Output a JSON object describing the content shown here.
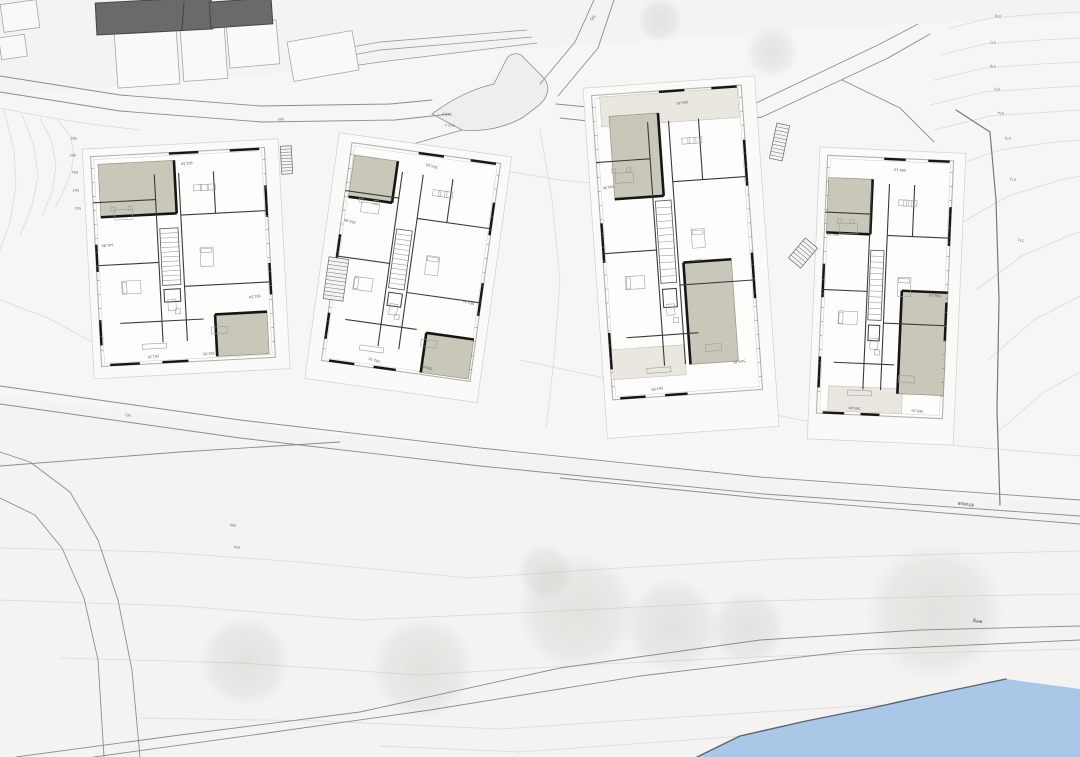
{
  "canvas": {
    "w": 1080,
    "h": 757
  },
  "colors": {
    "background": "#f4f3f1",
    "parcel": "#f7f6f4",
    "building_white": "#fdfdfc",
    "building_outline": "#b3b1ac",
    "terrace_dark": "#c9c7b9",
    "terrace_light": "#e9e7df",
    "existing_dark": "#6a6a6a",
    "wall_black": "#161616",
    "road_line": "#8f8d8b",
    "contour": "#dcdad6",
    "tree": "#b9b8b3",
    "water_fill": "#a9c7e6",
    "water_edge": "#5a6470",
    "label_text": "#444444"
  },
  "site": {
    "parcel": [
      0,
      96,
      300,
      70,
      430,
      56,
      560,
      46,
      820,
      28,
      1080,
      16,
      1080,
      505,
      760,
      478,
      400,
      442,
      0,
      396
    ],
    "contours": [
      [
        950,
        28,
        990,
        18,
        1040,
        14,
        1080,
        12
      ],
      [
        940,
        55,
        985,
        44,
        1040,
        40,
        1080,
        38
      ],
      [
        934,
        80,
        984,
        68,
        1040,
        64,
        1080,
        62
      ],
      [
        930,
        105,
        984,
        92,
        1045,
        88,
        1080,
        86
      ],
      [
        934,
        130,
        990,
        116,
        1050,
        112,
        1080,
        110
      ],
      [
        948,
        168,
        1000,
        150,
        1055,
        142,
        1080,
        140
      ],
      [
        958,
        225,
        1008,
        196,
        1060,
        180,
        1080,
        176
      ],
      [
        976,
        290,
        1022,
        256,
        1068,
        236,
        1080,
        232
      ],
      [
        988,
        360,
        1034,
        320,
        1080,
        296
      ],
      [
        998,
        432,
        1044,
        392,
        1080,
        372
      ],
      [
        58,
        120,
        70,
        136,
        74,
        154,
        71,
        172,
        64,
        190,
        56,
        206
      ],
      [
        40,
        118,
        52,
        142,
        56,
        166,
        52,
        192,
        42,
        216
      ],
      [
        22,
        114,
        34,
        146,
        38,
        176,
        32,
        206,
        20,
        236
      ],
      [
        4,
        110,
        14,
        150,
        16,
        186,
        10,
        222,
        0,
        250
      ],
      [
        0,
        300,
        48,
        318,
        92,
        342,
        130,
        358
      ],
      [
        0,
        108,
        40,
        116,
        90,
        124,
        140,
        130
      ],
      [
        430,
        150,
        500,
        170,
        560,
        180,
        620,
        186
      ],
      [
        540,
        130,
        552,
        200,
        560,
        280,
        554,
        360,
        546,
        428
      ],
      [
        520,
        360,
        660,
        390,
        800,
        420,
        960,
        446,
        1080,
        456
      ],
      [
        0,
        548,
        160,
        552,
        300,
        562,
        470,
        578,
        620,
        568,
        780,
        559,
        950,
        554,
        1080,
        551
      ],
      [
        0,
        600,
        180,
        606,
        360,
        620,
        560,
        611,
        760,
        601,
        960,
        596,
        1080,
        594
      ],
      [
        60,
        658,
        240,
        663,
        420,
        675,
        600,
        664,
        780,
        656,
        960,
        652,
        1080,
        649
      ],
      [
        140,
        718,
        320,
        721,
        500,
        729,
        680,
        717,
        860,
        706,
        1000,
        700
      ],
      [
        380,
        746,
        520,
        752,
        660,
        742,
        800,
        732
      ]
    ],
    "contour_labels": [
      {
        "text": "578",
        "x": 998,
        "y": 15,
        "rot": 187
      },
      {
        "text": "577",
        "x": 993,
        "y": 41,
        "rot": 187
      },
      {
        "text": "576",
        "x": 993,
        "y": 65,
        "rot": 187
      },
      {
        "text": "575",
        "x": 997,
        "y": 88,
        "rot": 187
      },
      {
        "text": "574",
        "x": 1001,
        "y": 112,
        "rot": 187
      },
      {
        "text": "573",
        "x": 1008,
        "y": 137,
        "rot": 187
      },
      {
        "text": "572",
        "x": 1013,
        "y": 178,
        "rot": 190
      },
      {
        "text": "571",
        "x": 1021,
        "y": 239,
        "rot": 195
      },
      {
        "text": "566",
        "x": 74,
        "y": 137,
        "rot": 183
      },
      {
        "text": "565",
        "x": 73,
        "y": 154,
        "rot": 183
      },
      {
        "text": "564",
        "x": 75,
        "y": 171,
        "rot": 183
      },
      {
        "text": "563",
        "x": 76,
        "y": 189,
        "rot": 183
      },
      {
        "text": "562",
        "x": 78,
        "y": 207,
        "rot": 183
      }
    ],
    "path_labels": [
      {
        "text": "565",
        "x": 592,
        "y": 17,
        "rot": 132
      },
      {
        "text": "564",
        "x": 281,
        "y": 118,
        "rot": 175
      },
      {
        "text": "561",
        "x": 128,
        "y": 414,
        "rot": 188
      },
      {
        "text": "565.2",
        "x": 447,
        "y": 113,
        "rot": 185
      },
      {
        "text": "565.7",
        "x": 450,
        "y": 124,
        "rot": 185
      },
      {
        "text": "560",
        "x": 233,
        "y": 524,
        "rot": 185
      },
      {
        "text": "559",
        "x": 237,
        "y": 546,
        "rot": 185
      }
    ],
    "street_labels": [
      {
        "text": "strasse",
        "x": 966,
        "y": 503,
        "rot": 187
      },
      {
        "text": "weg",
        "x": 978,
        "y": 620,
        "rot": 188
      }
    ],
    "trees": [
      [
        423,
        668,
        52
      ],
      [
        577,
        612,
        60
      ],
      [
        672,
        626,
        48
      ],
      [
        935,
        612,
        70
      ],
      [
        748,
        628,
        38
      ],
      [
        545,
        572,
        28
      ],
      [
        245,
        662,
        46
      ],
      [
        508,
        92,
        22
      ],
      [
        772,
        52,
        26
      ],
      [
        660,
        20,
        22
      ]
    ],
    "roads": [
      {
        "name": "road-upper-edge-a",
        "pts": [
          0,
          76,
          120,
          95,
          260,
          106,
          390,
          104,
          432,
          100
        ]
      },
      {
        "name": "road-upper-edge-b",
        "pts": [
          0,
          92,
          120,
          111,
          262,
          122,
          395,
          120,
          450,
          114
        ]
      },
      {
        "name": "path-ne-a",
        "pts": [
          540,
          84,
          575,
          42,
          594,
          0
        ]
      },
      {
        "name": "path-ne-b",
        "pts": [
          558,
          96,
          598,
          48,
          614,
          0
        ]
      },
      {
        "name": "road-right-a",
        "pts": [
          556,
          104,
          660,
          114,
          756,
          103,
          815,
          75,
          880,
          44,
          918,
          24
        ]
      },
      {
        "name": "road-right-b",
        "pts": [
          560,
          118,
          662,
          129,
          762,
          117,
          824,
          88,
          888,
          58,
          930,
          34
        ]
      },
      {
        "name": "drive-b4",
        "pts": [
          842,
          80,
          900,
          108,
          934,
          142
        ]
      },
      {
        "name": "drive-b2",
        "pts": [
          462,
          130,
          420,
          142,
          390,
          150
        ]
      },
      {
        "name": "road-mid-edge-a",
        "pts": [
          0,
          386,
          240,
          420,
          480,
          448,
          760,
          477,
          1080,
          500
        ]
      },
      {
        "name": "road-mid-edge-b",
        "pts": [
          0,
          404,
          240,
          438,
          480,
          466,
          764,
          494,
          1080,
          516
        ]
      },
      {
        "name": "road-mid-walk",
        "pts": [
          560,
          478,
          760,
          498,
          1080,
          524
        ]
      },
      {
        "name": "road-junction-west",
        "pts": [
          0,
          466,
          180,
          452,
          340,
          442
        ]
      },
      {
        "name": "road-left-branch-a",
        "pts": [
          0,
          452,
          30,
          462,
          70,
          492,
          98,
          540,
          118,
          600,
          132,
          670,
          140,
          757
        ]
      },
      {
        "name": "road-left-branch-b",
        "pts": [
          0,
          498,
          35,
          515,
          62,
          548,
          84,
          598,
          98,
          660,
          104,
          757
        ]
      },
      {
        "name": "road-lower-edge-a",
        "pts": [
          16,
          757,
          180,
          735,
          360,
          712,
          560,
          668,
          760,
          640,
          920,
          630,
          1080,
          626
        ]
      },
      {
        "name": "road-lower-edge-b",
        "pts": [
          94,
          757,
          260,
          734,
          430,
          710,
          640,
          676,
          860,
          650,
          1080,
          640
        ]
      }
    ],
    "turnaround_d": "M432,114 C456,96 476,88 494,84 L506,60 C510,52 520,52 524,58 L542,76 C552,86 548,98 538,106 L522,118 C504,128 482,132 462,130 Z",
    "retaining_lines": [
      [
        290,
        58,
        380,
        42,
        527,
        30
      ],
      [
        293,
        66,
        380,
        50,
        532,
        37
      ],
      [
        296,
        74,
        380,
        62,
        537,
        43
      ]
    ],
    "boundary": [
      956,
      110,
      990,
      132,
      996,
      200,
      999,
      300,
      997,
      410,
      1000,
      505
    ],
    "dark_buildings": [
      [
        96,
        0,
        116,
        32,
        -3
      ],
      [
        210,
        0,
        62,
        26,
        -4
      ]
    ],
    "outline_buildings": [
      [
        2,
        2,
        36,
        28,
        -8
      ],
      [
        0,
        36,
        26,
        22,
        -8
      ],
      [
        116,
        30,
        62,
        56,
        -4
      ],
      [
        182,
        28,
        44,
        52,
        -4
      ],
      [
        228,
        22,
        50,
        44,
        -5
      ],
      [
        290,
        36,
        66,
        40,
        -10
      ]
    ],
    "ext_stairs": [
      [
        281,
        146,
        11,
        28,
        -3,
        9
      ],
      [
        773,
        124,
        13,
        36,
        12,
        10
      ],
      [
        795,
        240,
        16,
        26,
        40,
        7
      ],
      [
        326,
        258,
        20,
        42,
        8,
        11
      ]
    ],
    "water": [
      697,
      757,
      740,
      736,
      806,
      721,
      876,
      707,
      944,
      692,
      1006,
      679,
      1080,
      689,
      1080,
      757
    ]
  },
  "buildings": [
    {
      "id": "building-1",
      "x": 96,
      "y": 152,
      "w": 174,
      "h": 210,
      "rot": -3,
      "pad": {
        "l": 8,
        "t": 8,
        "r": 14,
        "b": 12
      },
      "terraces": [
        {
          "dx": 7,
          "dy": 8,
          "w": 76,
          "h": 53,
          "tone": "dark"
        },
        {
          "dx": 116,
          "dy": 164,
          "w": 52,
          "h": 42,
          "tone": "dark"
        }
      ],
      "aprons": [],
      "marks": [
        {
          "t": "562.50",
          "fx": 0.55,
          "fy": 0.05
        },
        {
          "t": "561.90",
          "fx": 0.07,
          "fy": 0.42
        },
        {
          "t": "562.50",
          "fx": 0.9,
          "fy": 0.7
        },
        {
          "t": "561.35",
          "fx": 0.3,
          "fy": 0.96
        },
        {
          "t": "562.05",
          "fx": 0.62,
          "fy": 0.96
        }
      ]
    },
    {
      "id": "building-2",
      "x": 336,
      "y": 152,
      "w": 150,
      "h": 220,
      "rot": 8,
      "pad": {
        "l": 14,
        "t": 8,
        "r": 10,
        "b": 20
      },
      "terraces": [
        {
          "dx": 4,
          "dy": 12,
          "w": 44,
          "h": 42,
          "tone": "dark"
        },
        {
          "dx": 100,
          "dy": 178,
          "w": 48,
          "h": 40,
          "tone": "dark"
        }
      ],
      "aprons": [],
      "marks": [
        {
          "t": "563.20",
          "fx": 0.55,
          "fy": 0.05
        },
        {
          "t": "562.80",
          "fx": 0.06,
          "fy": 0.35
        },
        {
          "t": "563.20",
          "fx": 0.92,
          "fy": 0.64
        },
        {
          "t": "562.10",
          "fx": 0.35,
          "fy": 0.96
        },
        {
          "t": "562.60",
          "fx": 0.7,
          "fy": 0.96
        }
      ]
    },
    {
      "id": "building-3",
      "x": 602,
      "y": 90,
      "w": 150,
      "h": 305,
      "rot": -4,
      "pad": {
        "l": 8,
        "t": 8,
        "r": 14,
        "b": 38
      },
      "terraces": [
        {
          "dx": 16,
          "dy": 22,
          "w": 49,
          "h": 83,
          "tone": "dark"
        },
        {
          "dx": 80,
          "dy": 173,
          "w": 48,
          "h": 102,
          "tone": "dark"
        }
      ],
      "aprons": [
        {
          "dx": 8,
          "dy": 2,
          "w": 138,
          "h": 30,
          "tone": "light"
        },
        {
          "dx": 0,
          "dy": 255,
          "w": 75,
          "h": 30,
          "tone": "light"
        }
      ],
      "marks": [
        {
          "t": "565.40",
          "fx": 0.6,
          "fy": 0.04
        },
        {
          "t": "564.90",
          "fx": 0.07,
          "fy": 0.3
        },
        {
          "t": "565.40",
          "fx": 0.62,
          "fy": 0.56
        },
        {
          "t": "563.90",
          "fx": 0.3,
          "fy": 0.97
        },
        {
          "t": "564.20",
          "fx": 0.86,
          "fy": 0.9
        }
      ]
    },
    {
      "id": "building-4",
      "x": 822,
      "y": 158,
      "w": 126,
      "h": 258,
      "rot": 2.5,
      "pad": {
        "l": 8,
        "t": 8,
        "r": 12,
        "b": 26
      },
      "terraces": [
        {
          "dx": 2,
          "dy": 22,
          "w": 44,
          "h": 55,
          "tone": "dark"
        },
        {
          "dx": 80,
          "dy": 132,
          "w": 46,
          "h": 103,
          "tone": "dark"
        }
      ],
      "aprons": [
        {
          "dx": 11,
          "dy": 230,
          "w": 74,
          "h": 25,
          "tone": "light"
        }
      ],
      "marks": [
        {
          "t": "566.10",
          "fx": 0.58,
          "fy": 0.04
        },
        {
          "t": "565.60",
          "fx": 0.07,
          "fy": 0.3
        },
        {
          "t": "566.10",
          "fx": 0.9,
          "fy": 0.52
        },
        {
          "t": "564.80",
          "fx": 0.3,
          "fy": 0.97
        },
        {
          "t": "565.20",
          "fx": 0.8,
          "fy": 0.97
        }
      ]
    }
  ]
}
